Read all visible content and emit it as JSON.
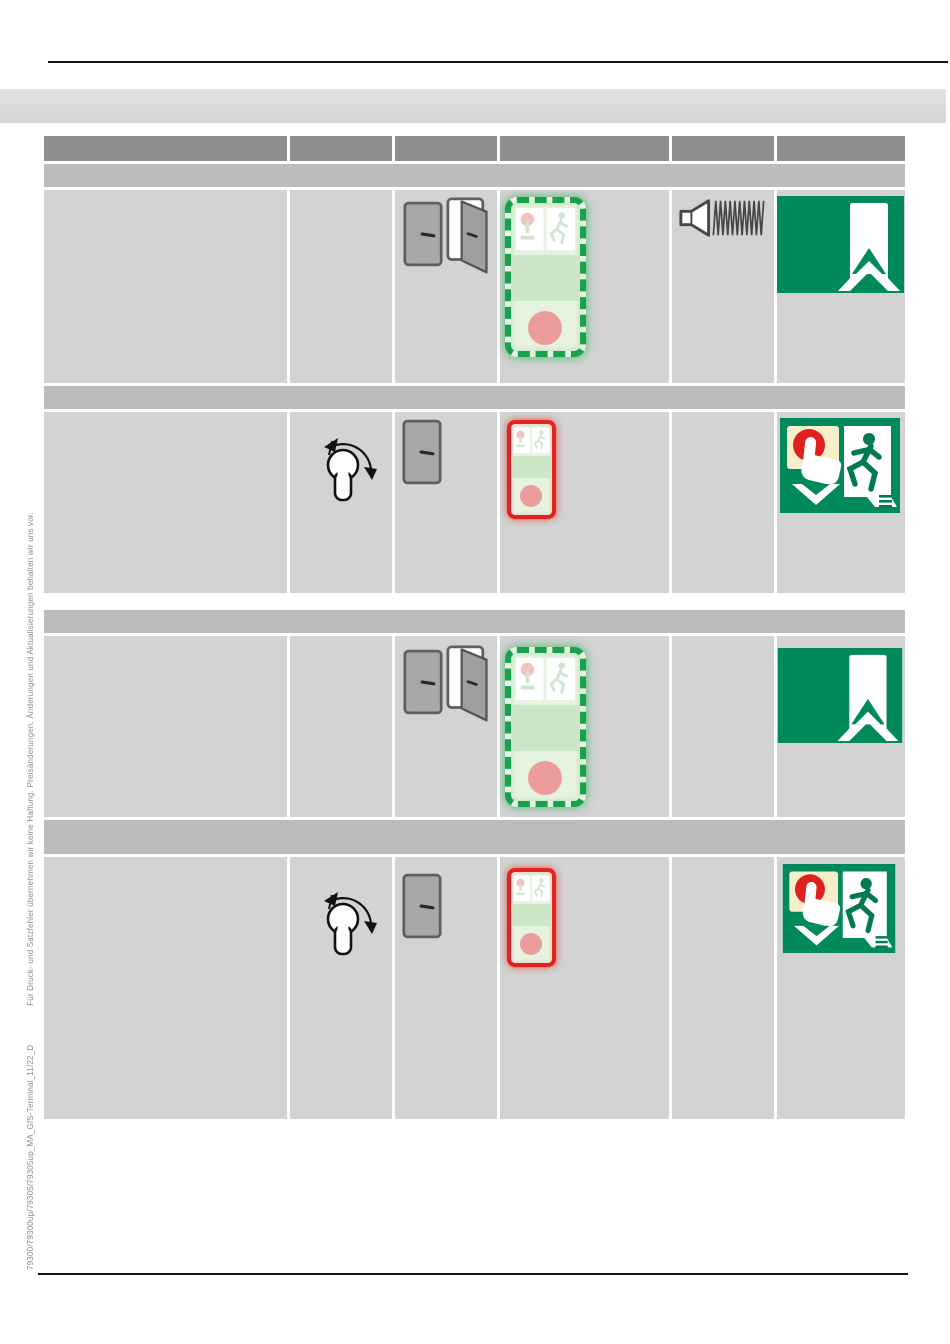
{
  "page": {
    "width": 950,
    "height": 1344,
    "background": "#ffffff",
    "kind": "product-manual-page"
  },
  "side_caption": {
    "doc_code": "79300/79300up/79305/79305up_MA_GfS-Terminal_11/22_D",
    "disclaimer": "Für Druck- und Satzfehler übernehmen wir keine Haftung. Preisänderungen, Änderungen und Aktualisierungen behalten wir uns vor."
  },
  "colors": {
    "banner_gray": "#d8d8d8",
    "table_header_gray": "#8f8f8f",
    "section_bar_gray": "#bcbcbc",
    "cell_gray": "#d3d3d3",
    "sign_green": "#008a5c",
    "terminal_green_border": "#17a24b",
    "terminal_red_border": "#e42320",
    "terminal_face_green": "#e7f3e1",
    "terminal_band_green": "#cde6c8",
    "button_pink": "#ec9d9b",
    "alarm_red": "#e01f1f",
    "door_gray": "#a8a8a8",
    "cream_panel": "#f6efca"
  },
  "tables": {
    "upper": {
      "column_count": 6,
      "rows": [
        {
          "kind": "column-header",
          "cells": [
            "",
            "",
            "",
            "",
            "",
            ""
          ]
        },
        {
          "kind": "section-bar",
          "text": ""
        },
        {
          "kind": "icon-row",
          "cells": [
            "",
            "",
            "door-closed-icon + door-open-icon",
            "terminal-unlocked-green-dashed",
            "alarm-sounder-icon",
            "emergency-exit-door-sign"
          ]
        },
        {
          "kind": "section-bar",
          "text": ""
        },
        {
          "kind": "icon-row",
          "cells": [
            "",
            "key-switch-turn-icon",
            "door-closed-icon",
            "terminal-locked-red",
            "",
            "press-button-exit-sign"
          ]
        }
      ]
    },
    "lower": {
      "column_count": 6,
      "rows": [
        {
          "kind": "section-bar",
          "text": ""
        },
        {
          "kind": "icon-row",
          "cells": [
            "",
            "",
            "door-closed-icon + door-open-icon",
            "terminal-unlocked-green-dashed",
            "",
            "emergency-exit-door-sign"
          ]
        },
        {
          "kind": "section-bar",
          "text": ""
        },
        {
          "kind": "icon-row",
          "cells": [
            "",
            "key-switch-turn-icon",
            "door-closed-icon",
            "terminal-locked-red",
            "",
            "press-button-exit-sign"
          ]
        }
      ]
    }
  }
}
